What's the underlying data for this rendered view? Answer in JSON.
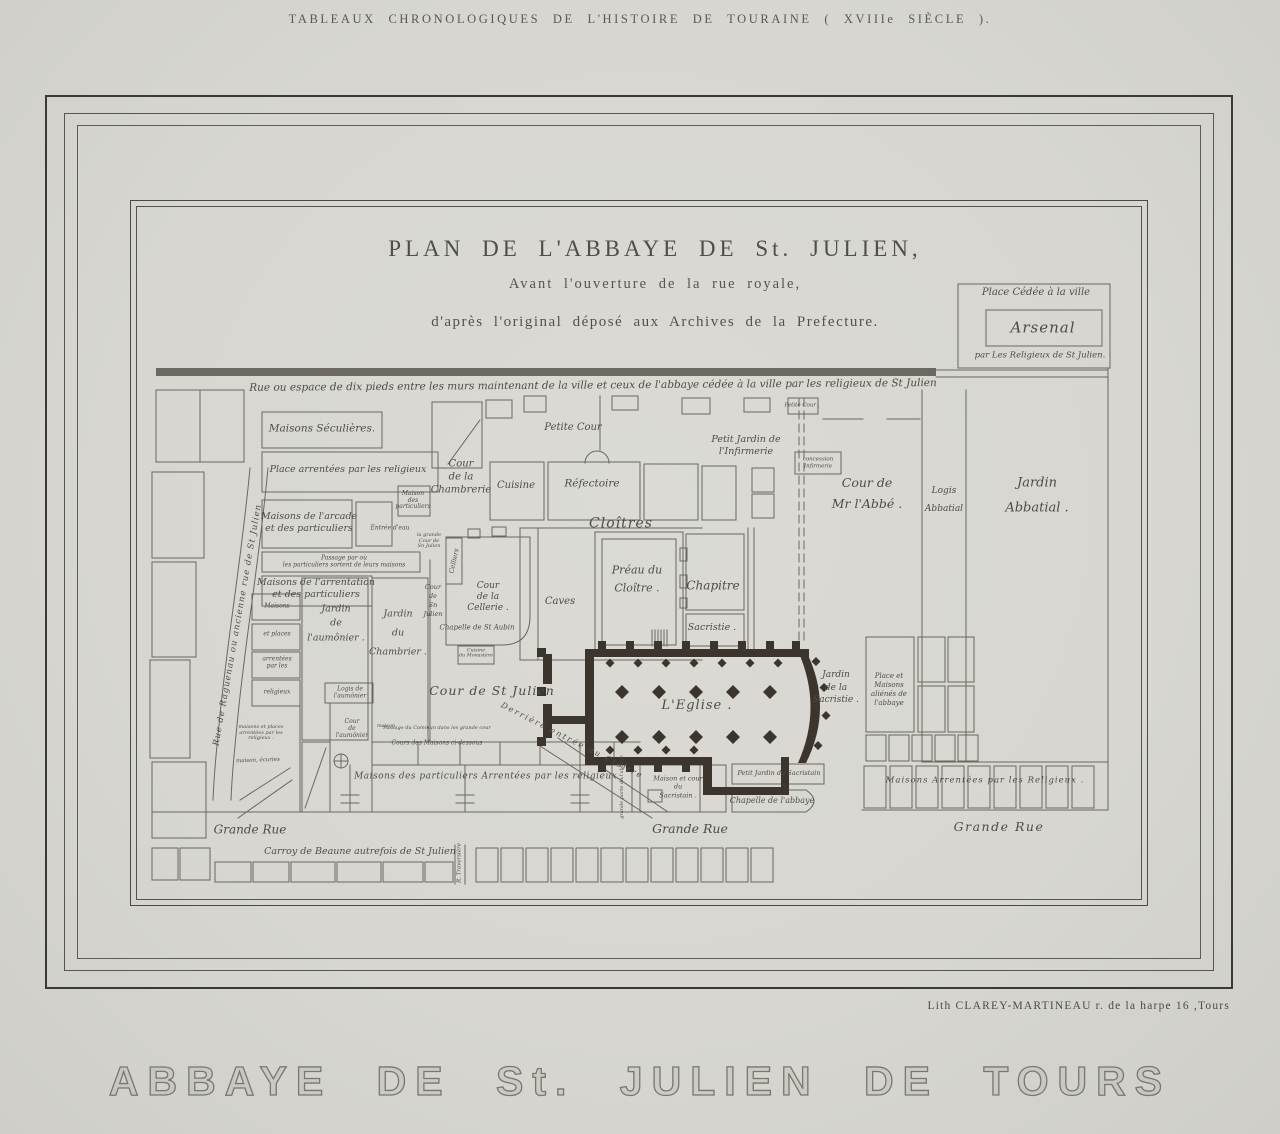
{
  "header": {
    "text": "TABLEAUX CHRONOLOGIQUES DE L'HISTOIRE DE TOURAINE ( XVIIIe SIÈCLE )."
  },
  "plate": {
    "title1": "PLAN DE L'ABBAYE DE St. JULIEN,",
    "title2": "Avant l'ouverture de la rue royale,",
    "title3": "d'après l'original déposé aux Archives de la Prefecture."
  },
  "credit": {
    "text": "Lith CLAREY-MARTINEAU r. de la harpe 16 ,Tours"
  },
  "footer": {
    "text": "ABBAYE DE St. JULIEN DE TOURS"
  },
  "labels": [
    {
      "n": "rue-espace-dix-pieds",
      "t": "Rue ou espace de dix pieds entre les murs maintenant de la ville et ceux de l'abbaye cédée à la ville par les religieux de St Julien",
      "x": 593,
      "y": 386,
      "s": 10.5,
      "w": 720,
      "r": -0.4
    },
    {
      "n": "place-cedee-ville",
      "t": "Place Cédée à la ville",
      "x": 1036,
      "y": 293,
      "s": 10
    },
    {
      "n": "arsenal",
      "t": "Arsenal",
      "x": 1043,
      "y": 328,
      "s": 15,
      "ls": 1
    },
    {
      "n": "par-les-religieux",
      "t": "par Les Religieux de St Julien.",
      "x": 1040,
      "y": 356,
      "s": 8.5
    },
    {
      "n": "maisons-seculieres",
      "t": "Maisons Séculières.",
      "x": 322,
      "y": 429,
      "s": 10.5
    },
    {
      "n": "place-arrentees",
      "t": "Place arrentées par les religieux",
      "x": 348,
      "y": 470,
      "s": 9.5,
      "w": 180
    },
    {
      "n": "maisons-arcade",
      "t": "Maisons de l'arcade\net des particuliers",
      "x": 309,
      "y": 523,
      "s": 9.5
    },
    {
      "n": "maison-des-particuliers",
      "t": "Maison\ndes\nparticuliers",
      "x": 413,
      "y": 501,
      "s": 6,
      "lh": 1.1
    },
    {
      "n": "passage-particuliers",
      "t": "Passage par où\nles particuliers sortent de leurs maisons",
      "x": 344,
      "y": 562,
      "s": 6,
      "lh": 1.1
    },
    {
      "n": "maisons-arrentation",
      "t": "Maisons de l'arrentation\net des particuliers",
      "x": 316,
      "y": 589,
      "s": 9.5
    },
    {
      "n": "entree-eau",
      "t": "Entrée d'eau",
      "x": 390,
      "y": 528,
      "s": 6
    },
    {
      "n": "grande-cour-tiny",
      "t": "la grande\nCour de\nSn Julien",
      "x": 429,
      "y": 541,
      "s": 5,
      "lh": 1.1
    },
    {
      "n": "cour-chambrerie",
      "t": "Cour\nde la\nChambrerie",
      "x": 461,
      "y": 477,
      "s": 10,
      "lh": 1.3
    },
    {
      "n": "petite-cour-center",
      "t": "Petite Cour",
      "x": 573,
      "y": 428,
      "s": 10
    },
    {
      "n": "cuisine",
      "t": "Cuisine",
      "x": 516,
      "y": 486,
      "s": 10
    },
    {
      "n": "refectoire",
      "t": "Réfectoire",
      "x": 592,
      "y": 484,
      "s": 10.5
    },
    {
      "n": "cloitres",
      "t": "Cloîtres",
      "x": 621,
      "y": 524,
      "s": 14,
      "ls": 1
    },
    {
      "n": "preau-cloitre",
      "t": "Préau du\nCloître .",
      "x": 637,
      "y": 579,
      "s": 11,
      "lh": 1.6
    },
    {
      "n": "chapitre",
      "t": "Chapitre",
      "x": 713,
      "y": 586,
      "s": 12
    },
    {
      "n": "sacristie",
      "t": "Sacristie .",
      "x": 712,
      "y": 628,
      "s": 9.5
    },
    {
      "n": "caves",
      "t": "Caves",
      "x": 560,
      "y": 602,
      "s": 10
    },
    {
      "n": "celliers",
      "t": "Celliers",
      "x": 454,
      "y": 561,
      "s": 6.5,
      "r": -78
    },
    {
      "n": "cour-sn-julien-vertical",
      "t": "Cour\nde\nSn\nJulien",
      "x": 433,
      "y": 601,
      "s": 6.5,
      "lh": 1.4
    },
    {
      "n": "cour-cellerie",
      "t": "Cour\nde la\nCellerie .",
      "x": 488,
      "y": 597,
      "s": 9,
      "lh": 1.2
    },
    {
      "n": "chapelle-st-aubin",
      "t": "Chapelle de St Aubin",
      "x": 477,
      "y": 628,
      "s": 7
    },
    {
      "n": "cuisine-monastere",
      "t": "Cuisine\ndu Monastère",
      "x": 476,
      "y": 654,
      "s": 4.8,
      "lh": 1.1
    },
    {
      "n": "petit-jardin-infirmerie",
      "t": "Petit Jardin de\nl'Infirmerie",
      "x": 746,
      "y": 446,
      "s": 9.5
    },
    {
      "n": "petite-cour-right",
      "t": "Petite Cour .",
      "x": 802,
      "y": 406,
      "s": 5.5
    },
    {
      "n": "concession-infirmerie",
      "t": "concession\nInfirmerie",
      "x": 818,
      "y": 463,
      "s": 5.5,
      "lh": 1.2
    },
    {
      "n": "cour-mr-abbe",
      "t": "Cour de\nMr l'Abbé .",
      "x": 867,
      "y": 493,
      "s": 12.5,
      "lh": 1.7
    },
    {
      "n": "logis-abbatial",
      "t": "Logis\nAbbatial",
      "x": 944,
      "y": 500,
      "s": 9,
      "lh": 2.0
    },
    {
      "n": "jardin-abbatial",
      "t": "Jardin\nAbbatial .",
      "x": 1037,
      "y": 496,
      "s": 13,
      "lh": 1.9
    },
    {
      "n": "jardin-aumonier",
      "t": "Jardin\nde\nl'aumônier .",
      "x": 336,
      "y": 624,
      "s": 9.5,
      "lh": 1.5
    },
    {
      "n": "jardin-chambrier",
      "t": "Jardin\ndu\nChambrier .",
      "x": 398,
      "y": 633,
      "s": 9.5,
      "lh": 2.0
    },
    {
      "n": "maisons-box1",
      "t": "Maisons",
      "x": 277,
      "y": 606,
      "s": 6
    },
    {
      "n": "maisons-box2",
      "t": "et places",
      "x": 277,
      "y": 634,
      "s": 6
    },
    {
      "n": "maisons-box3",
      "t": "arrentées\npar les",
      "x": 277,
      "y": 663,
      "s": 6,
      "lh": 1.1
    },
    {
      "n": "maisons-box4",
      "t": "religieux",
      "x": 277,
      "y": 692,
      "s": 6
    },
    {
      "n": "maisons-places-tiny",
      "t": "maisons et places\narrentées par les\nreligieux .",
      "x": 261,
      "y": 733,
      "s": 5,
      "lh": 1.1
    },
    {
      "n": "maison-ecuries",
      "t": "maison, écuries",
      "x": 258,
      "y": 761,
      "s": 5.5,
      "r": -2
    },
    {
      "n": "logis-aumonier",
      "t": "Logis de\nl'aumônier",
      "x": 350,
      "y": 693,
      "s": 6,
      "lh": 1.1
    },
    {
      "n": "cour-aumonier",
      "t": "Cour\nde\nl'aumônier",
      "x": 352,
      "y": 729,
      "s": 6,
      "lh": 1.2
    },
    {
      "n": "maison-tiny",
      "t": "maison",
      "x": 386,
      "y": 726,
      "s": 5
    },
    {
      "n": "cour-st-julien",
      "t": "Cour de St Julien",
      "x": 492,
      "y": 691,
      "s": 12.5,
      "ls": 1
    },
    {
      "n": "passage-grande-cour",
      "t": "Passage du Commun dans les grande cour",
      "x": 437,
      "y": 728,
      "s": 5
    },
    {
      "n": "cours-des-maisons",
      "t": "Cours des Maisons ci-dessous",
      "x": 437,
      "y": 743,
      "s": 6
    },
    {
      "n": "maisons-particuliers-arrentees",
      "t": "Maisons des particuliers Arrentées par les religieux .",
      "x": 489,
      "y": 777,
      "s": 9,
      "ls": 0.5
    },
    {
      "n": "derriere-entree-cloitre",
      "t": "Derrière  entrée  du  Cloître",
      "x": 572,
      "y": 741,
      "s": 8,
      "r": 27,
      "ls": 2
    },
    {
      "n": "l-eglise",
      "t": "L'Eglise .",
      "x": 697,
      "y": 706,
      "s": 13,
      "ls": 1
    },
    {
      "n": "jardin-sacristie",
      "t": "Jardin\nde la\nSacristie .",
      "x": 836,
      "y": 688,
      "s": 9,
      "lh": 1.4
    },
    {
      "n": "place-maisons-alienes",
      "t": "Place et\nMaisons\naliénés de\nl'abbaye",
      "x": 889,
      "y": 690,
      "s": 7,
      "lh": 1.3
    },
    {
      "n": "maison-cour-sacristain",
      "t": "Maison et cour\ndu\nSacristain .",
      "x": 678,
      "y": 787,
      "s": 6.5,
      "lh": 1.3
    },
    {
      "n": "petit-jardin-sacristain",
      "t": "Petit Jardin du Sacristain",
      "x": 779,
      "y": 773,
      "s": 6.5
    },
    {
      "n": "chapelle-abbaye",
      "t": "Chapelle de l'abbaye",
      "x": 772,
      "y": 801,
      "s": 8
    },
    {
      "n": "grande-porte-abbaye",
      "t": "grande porte de l'abbaye",
      "x": 622,
      "y": 787,
      "s": 5,
      "r": -90
    },
    {
      "n": "maisons-arrentees-religieux",
      "t": "Maisons Arrentées  par les Religieux .",
      "x": 985,
      "y": 781,
      "s": 8.5,
      "ls": 1
    },
    {
      "n": "grande-rue-left",
      "t": "Grande Rue",
      "x": 250,
      "y": 830,
      "s": 12
    },
    {
      "n": "grande-rue-center",
      "t": "Grande Rue",
      "x": 690,
      "y": 829,
      "s": 12.5
    },
    {
      "n": "grande-rue-right",
      "t": "Grande Rue",
      "x": 999,
      "y": 827,
      "s": 12.5,
      "ls": 1.5
    },
    {
      "n": "carroy-de-beaune",
      "t": "Carroy de Beaune autrefois de St Julien",
      "x": 360,
      "y": 852,
      "s": 9.5
    },
    {
      "n": "rue-traversiere",
      "t": "R. Traversière",
      "x": 460,
      "y": 863,
      "s": 5.5,
      "r": -90
    },
    {
      "n": "rue-raguenau",
      "t": "Rue de Raguenau ou ancienne rue de St Julien",
      "x": 238,
      "y": 625,
      "s": 8.5,
      "r": -80,
      "ls": 1
    }
  ]
}
